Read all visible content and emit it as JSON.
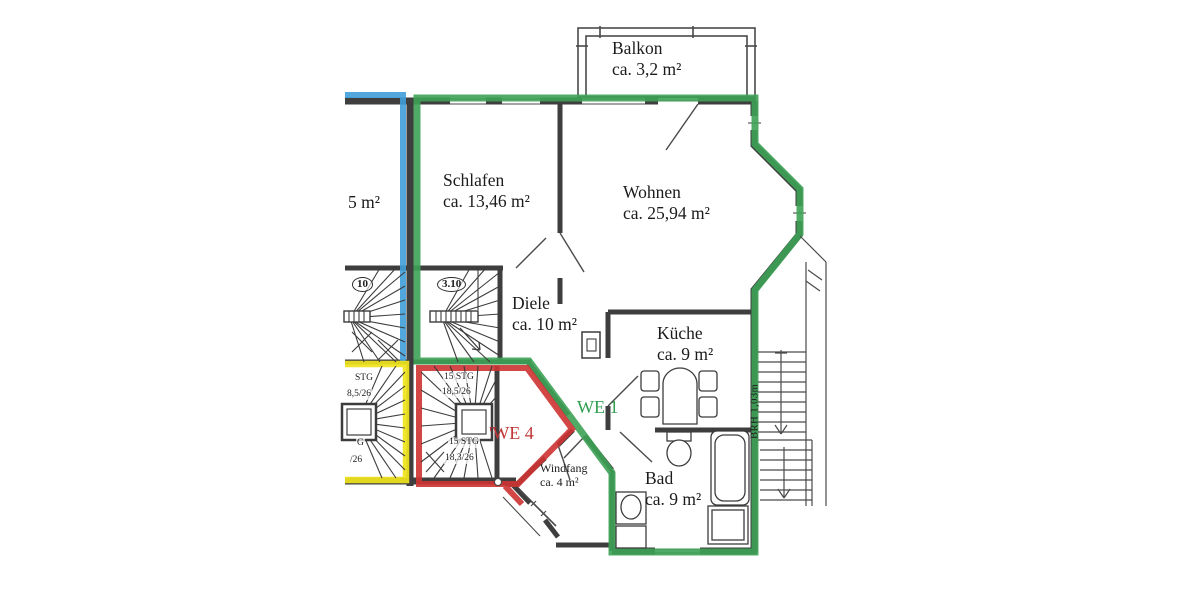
{
  "plan_type": "apartment floor plan",
  "rooms": {
    "balkon": {
      "name": "Balkon",
      "area": "ca. 3,2 m²"
    },
    "schlafen": {
      "name": "Schlafen",
      "area": "ca. 13,46 m²"
    },
    "wohnen": {
      "name": "Wohnen",
      "area": "ca. 25,94 m²"
    },
    "diele": {
      "name": "Diele",
      "area": "ca. 10 m²"
    },
    "kueche": {
      "name": "Küche",
      "area": "ca. 9 m²"
    },
    "bad": {
      "name": "Bad",
      "area": "ca. 9 m²"
    },
    "windfang": {
      "name": "Windfang",
      "area": "ca. 4 m²"
    },
    "cropped_left_room": {
      "area": "5 m²"
    }
  },
  "units": {
    "we1": {
      "label": "WE 1",
      "color": "#2f9e4e"
    },
    "we4": {
      "label": "'WE 4",
      "color": "#c13434"
    }
  },
  "stairs": {
    "upper_stair_number": "3.10",
    "upper_stair_number_cropped": "10",
    "we4_stair": {
      "line1": "15 STG",
      "line2": "18,5/26",
      "line3": "15 STG",
      "line4": "18,3/26"
    },
    "cropped_stair": {
      "line1": "STG",
      "line2": "8,5/26",
      "line3": "G",
      "line4": "/26"
    }
  },
  "annotations": {
    "parapet_height": "BRH 1,03m"
  },
  "colors": {
    "we1_boundary": "#3da255",
    "we2_boundary": "#3f9fd8",
    "we3_boundary": "#f0e41c",
    "we4_boundary": "#cf3333",
    "walls": "#3f3e3e"
  }
}
